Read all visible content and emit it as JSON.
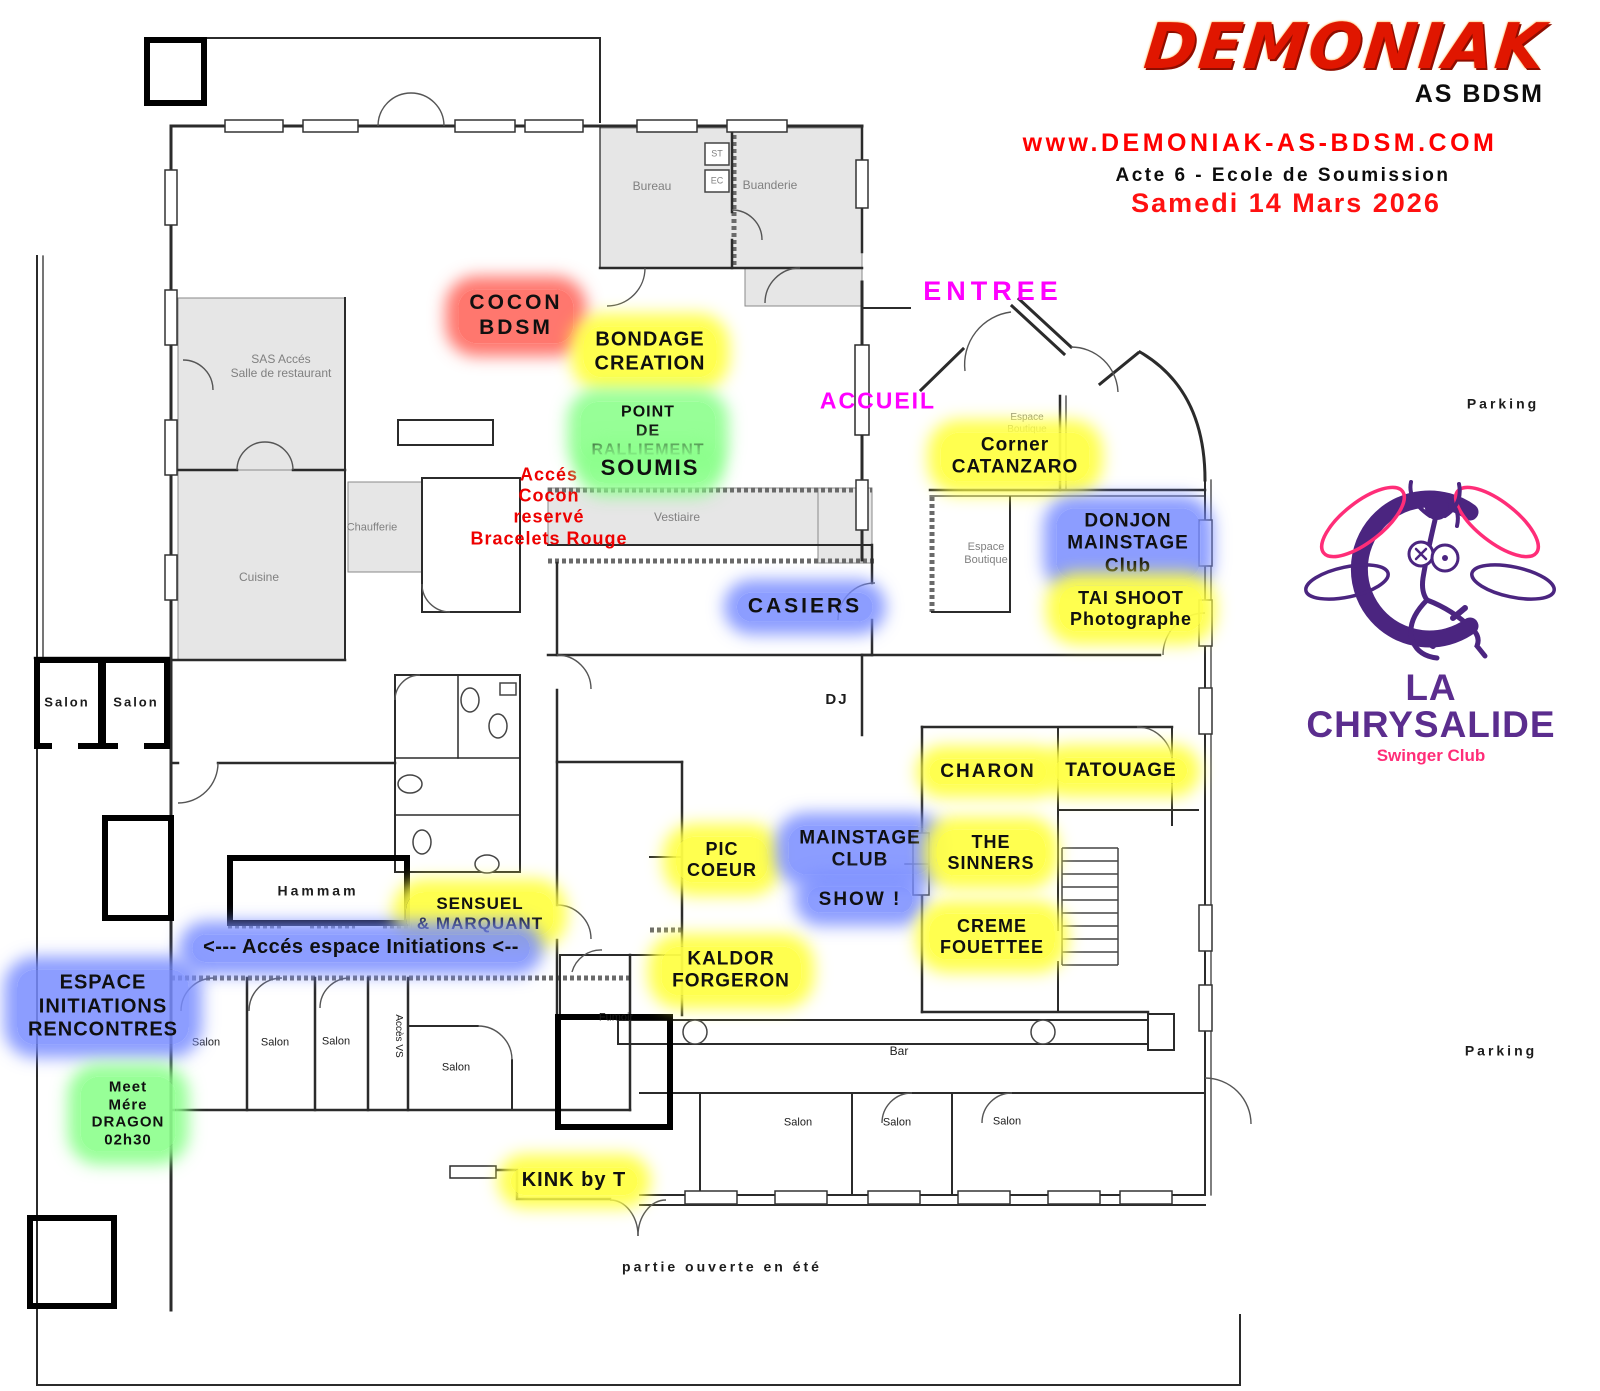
{
  "header": {
    "logo": "DEMONIAK",
    "logo_sub": "AS BDSM",
    "website": "www.DEMONIAK-AS-BDSM.COM",
    "event": "Acte 6 - Ecole de Soumission",
    "date": "Samedi 14 Mars 2026"
  },
  "venue": {
    "name": "LA CHRYSALIDE",
    "tagline": "Swinger Club"
  },
  "colors": {
    "brand_red": "#e01600",
    "url_red": "#ff0000",
    "magenta": "#ff00ff",
    "purple": "#5b2d8e",
    "pink": "#ff2d78",
    "text": {
      "gray": "#808080",
      "black": "#1c1c1c",
      "red": "#ee0000",
      "magenta": "#ff00ff"
    },
    "glows": {
      "yellow": "rgba(255,255,70,0.95)",
      "blue": "rgba(120,140,255,0.85)",
      "green": "rgba(140,255,140,0.9)",
      "red": "rgba(255,95,85,0.85)"
    }
  },
  "plan": {
    "highlights": [
      {
        "name": "label-cocon-bdsm",
        "text": "COCON\nBDSM",
        "x": 516,
        "y": 316,
        "glow": "red",
        "size": 21,
        "ls": 3
      },
      {
        "name": "label-bondage-creation",
        "text": "BONDAGE\nCREATION",
        "x": 650,
        "y": 352,
        "glow": "yellow",
        "size": 20,
        "ls": 1
      },
      {
        "name": "label-point-ralliement",
        "text": "POINT\nDE\nRALLIEMENT",
        "x": 648,
        "y": 432,
        "glow": "green",
        "size": 16,
        "ls": 1
      },
      {
        "name": "label-soumis",
        "text": "SOUMIS",
        "x": 650,
        "y": 468,
        "glow": "green",
        "size": 22,
        "ls": 2
      },
      {
        "name": "label-corner-catanzaro",
        "text": "Corner\nCATANZARO",
        "x": 1015,
        "y": 457,
        "glow": "yellow",
        "size": 19,
        "ls": 1
      },
      {
        "name": "label-donjon-mainstage",
        "text": "DONJON\nMAINSTAGE\nClub",
        "x": 1128,
        "y": 544,
        "glow": "blue",
        "size": 19,
        "ls": 1
      },
      {
        "name": "label-tai-shoot",
        "text": "TAI SHOOT\nPhotographe",
        "x": 1131,
        "y": 609,
        "glow": "yellow",
        "size": 18,
        "ls": 1
      },
      {
        "name": "label-casiers",
        "text": "CASIERS",
        "x": 805,
        "y": 607,
        "glow": "blue",
        "size": 21,
        "ls": 3
      },
      {
        "name": "label-charon",
        "text": "CHARON",
        "x": 988,
        "y": 772,
        "glow": "yellow",
        "size": 19,
        "ls": 2
      },
      {
        "name": "label-tatouage",
        "text": "TATOUAGE",
        "x": 1121,
        "y": 771,
        "glow": "yellow",
        "size": 19,
        "ls": 1
      },
      {
        "name": "label-pic-coeur",
        "text": "PIC\nCOEUR",
        "x": 722,
        "y": 860,
        "glow": "yellow",
        "size": 18,
        "ls": 1
      },
      {
        "name": "label-mainstage-club",
        "text": "MAINSTAGE\nCLUB",
        "x": 860,
        "y": 850,
        "glow": "blue",
        "size": 19,
        "ls": 1
      },
      {
        "name": "label-show",
        "text": "SHOW !",
        "x": 860,
        "y": 900,
        "glow": "blue",
        "size": 19,
        "ls": 2
      },
      {
        "name": "label-the-sinners",
        "text": "THE\nSINNERS",
        "x": 991,
        "y": 853,
        "glow": "yellow",
        "size": 18,
        "ls": 1
      },
      {
        "name": "label-creme-fouettee",
        "text": "CREME\nFOUETTEE",
        "x": 992,
        "y": 937,
        "glow": "yellow",
        "size": 18,
        "ls": 1
      },
      {
        "name": "label-sensuel-marquant",
        "text": "SENSUEL\n& MARQUANT",
        "x": 480,
        "y": 914,
        "glow": "yellow",
        "size": 17,
        "ls": 1
      },
      {
        "name": "label-acces-espace-initiations",
        "text": "<--- Accés espace Initiations <--",
        "x": 361,
        "y": 948,
        "glow": "blue",
        "size": 20,
        "ls": 0.5
      },
      {
        "name": "label-kaldor-forgeron",
        "text": "KALDOR\nFORGERON",
        "x": 731,
        "y": 971,
        "glow": "yellow",
        "size": 19,
        "ls": 1
      },
      {
        "name": "label-espace-initiations-rencontres",
        "text": "ESPACE\nINITIATIONS\nRENCONTRES",
        "x": 103,
        "y": 1007,
        "glow": "blue",
        "size": 20,
        "ls": 1
      },
      {
        "name": "label-meet-mere-dragon",
        "text": "Meet\nMére\nDRAGON\n02h30",
        "x": 128,
        "y": 1114,
        "glow": "green",
        "size": 15,
        "ls": 1
      },
      {
        "name": "label-kink-by-t",
        "text": "KINK by T",
        "x": 574,
        "y": 1181,
        "glow": "yellow",
        "size": 20,
        "ls": 1
      }
    ],
    "plain_labels": [
      {
        "name": "label-entree",
        "text": "ENTREE",
        "x": 993,
        "y": 292,
        "color": "magenta",
        "size": 27,
        "ls": 5,
        "weight": 700
      },
      {
        "name": "label-accueil",
        "text": "ACCUEIL",
        "x": 878,
        "y": 401,
        "color": "magenta",
        "size": 23,
        "ls": 2,
        "weight": 700
      },
      {
        "name": "label-acces-cocon",
        "text": "Accés\nCocon\nreservé\nBracelets Rouge",
        "x": 549,
        "y": 507,
        "color": "red",
        "size": 18,
        "ls": 1,
        "weight": 700
      },
      {
        "name": "label-dj",
        "text": "DJ",
        "x": 837,
        "y": 700,
        "color": "black",
        "size": 15,
        "ls": 2,
        "weight": 700
      },
      {
        "name": "room-bureau",
        "text": "Bureau",
        "x": 652,
        "y": 186,
        "color": "gray",
        "size": 12
      },
      {
        "name": "room-buanderie",
        "text": "Buanderie",
        "x": 770,
        "y": 185,
        "color": "gray",
        "size": 12
      },
      {
        "name": "room-st",
        "text": "ST",
        "x": 717,
        "y": 154,
        "color": "gray",
        "size": 9
      },
      {
        "name": "room-ec",
        "text": "EC",
        "x": 717,
        "y": 181,
        "color": "gray",
        "size": 9
      },
      {
        "name": "room-sas-acces",
        "text": "SAS Accés\nSalle de restaurant",
        "x": 281,
        "y": 366,
        "color": "gray",
        "size": 12
      },
      {
        "name": "room-cuisine",
        "text": "Cuisine",
        "x": 259,
        "y": 577,
        "color": "gray",
        "size": 12
      },
      {
        "name": "room-chaufferie",
        "text": "Chaufferie",
        "x": 372,
        "y": 528,
        "color": "gray",
        "size": 11
      },
      {
        "name": "room-vestiaire",
        "text": "Vestiaire",
        "x": 677,
        "y": 517,
        "color": "gray",
        "size": 12
      },
      {
        "name": "room-salon-1",
        "text": "Salon",
        "x": 67,
        "y": 702,
        "color": "black",
        "size": 13,
        "ls": 2,
        "weight": 700
      },
      {
        "name": "room-salon-2",
        "text": "Salon",
        "x": 136,
        "y": 702,
        "color": "black",
        "size": 13,
        "ls": 2,
        "weight": 700
      },
      {
        "name": "room-hammam",
        "text": "Hammam",
        "x": 318,
        "y": 891,
        "color": "black",
        "size": 14,
        "ls": 3,
        "weight": 700
      },
      {
        "name": "room-salon-3",
        "text": "Salon",
        "x": 206,
        "y": 1043,
        "color": "black",
        "size": 11
      },
      {
        "name": "room-salon-4",
        "text": "Salon",
        "x": 275,
        "y": 1043,
        "color": "black",
        "size": 11
      },
      {
        "name": "room-salon-5",
        "text": "Salon",
        "x": 336,
        "y": 1042,
        "color": "black",
        "size": 11
      },
      {
        "name": "room-acces-vs",
        "text": "Accès VS",
        "x": 398,
        "y": 1036,
        "color": "black",
        "size": 10,
        "rotate": 90
      },
      {
        "name": "room-salon-6",
        "text": "Salon",
        "x": 456,
        "y": 1068,
        "color": "black",
        "size": 11
      },
      {
        "name": "room-fumoir",
        "text": "Fumoir",
        "x": 616,
        "y": 1018,
        "color": "black",
        "size": 11
      },
      {
        "name": "room-bar",
        "text": "Bar",
        "x": 899,
        "y": 1051,
        "color": "black",
        "size": 12
      },
      {
        "name": "room-salon-7",
        "text": "Salon",
        "x": 798,
        "y": 1123,
        "color": "black",
        "size": 11
      },
      {
        "name": "room-salon-8",
        "text": "Salon",
        "x": 897,
        "y": 1123,
        "color": "black",
        "size": 11
      },
      {
        "name": "room-salon-9",
        "text": "Salon",
        "x": 1007,
        "y": 1122,
        "color": "black",
        "size": 11
      },
      {
        "name": "room-espace-boutique-1",
        "text": "Espace\nBoutique",
        "x": 1027,
        "y": 424,
        "color": "gray",
        "size": 10
      },
      {
        "name": "room-espace-boutique-2",
        "text": "Espace\nBoutique",
        "x": 986,
        "y": 554,
        "color": "gray",
        "size": 11
      },
      {
        "name": "label-parking-top",
        "text": "Parking",
        "x": 1503,
        "y": 404,
        "color": "black",
        "size": 14,
        "ls": 3,
        "weight": 700
      },
      {
        "name": "label-parking-bottom",
        "text": "Parking",
        "x": 1501,
        "y": 1051,
        "color": "black",
        "size": 14,
        "ls": 3,
        "weight": 700
      },
      {
        "name": "label-partie-ouverte",
        "text": "partie ouverte en été",
        "x": 722,
        "y": 1267,
        "color": "black",
        "size": 14,
        "ls": 3,
        "weight": 700
      }
    ]
  }
}
